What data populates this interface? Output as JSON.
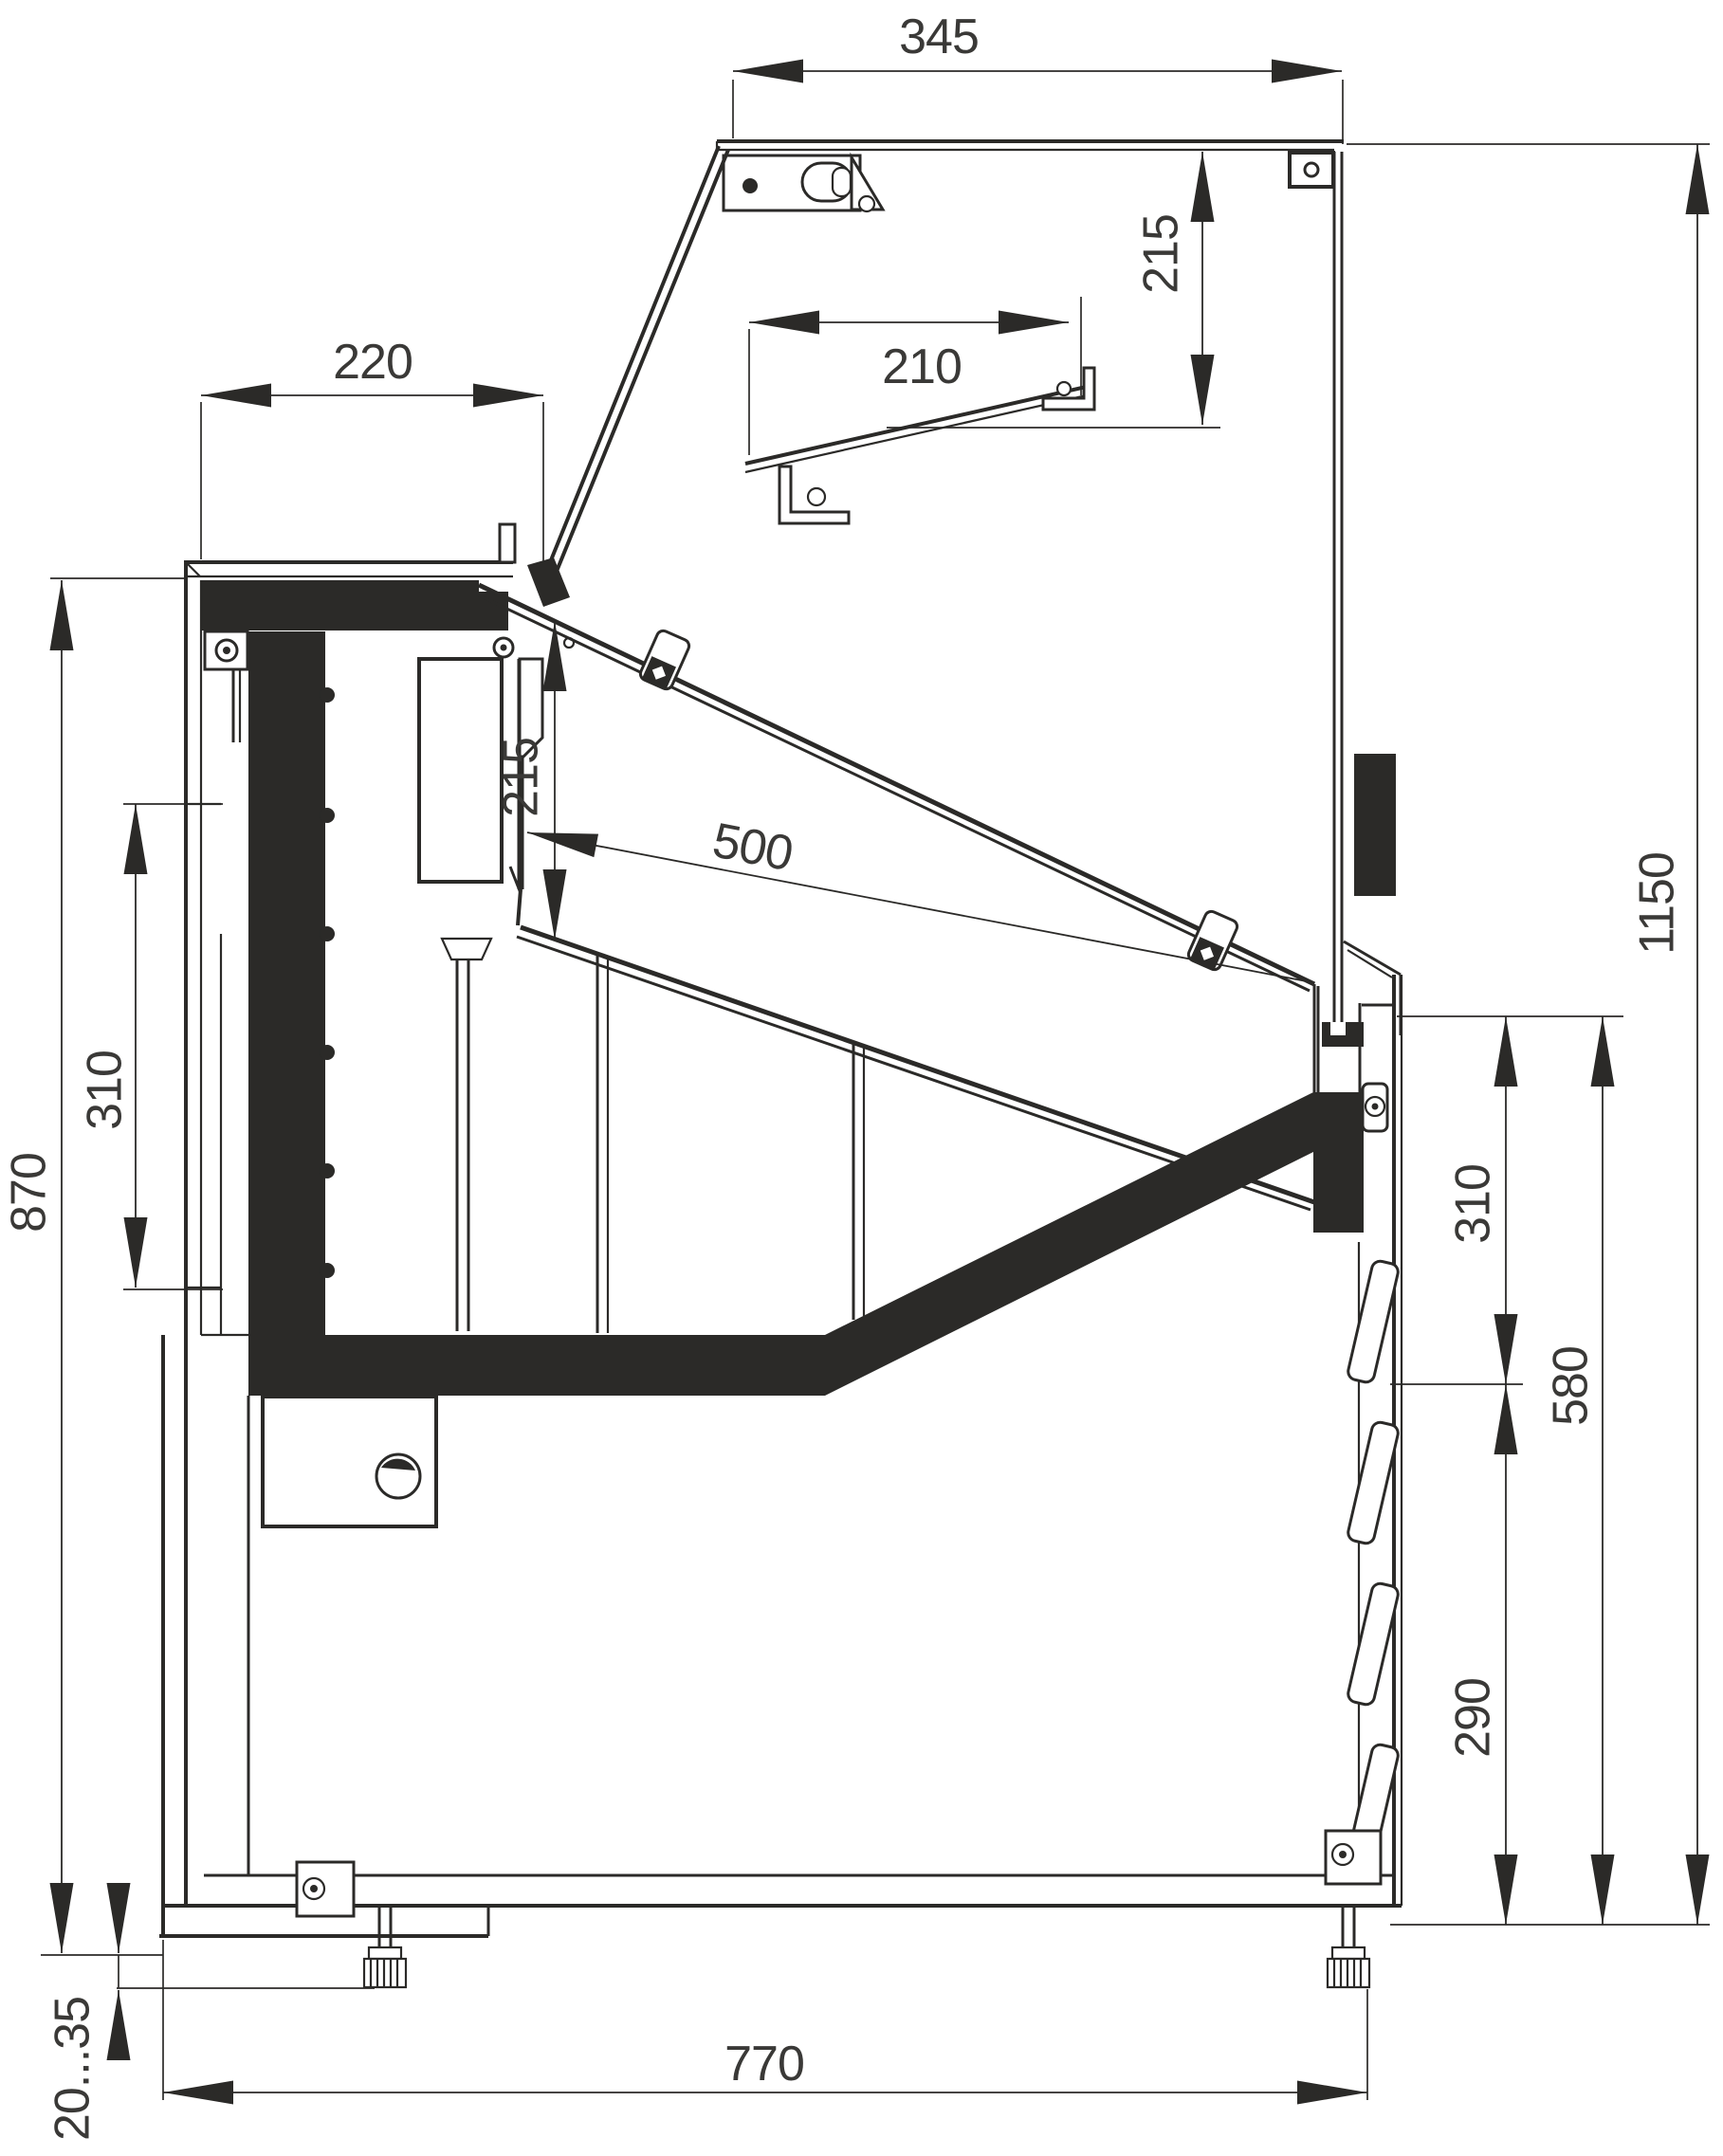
{
  "drawing": {
    "kind": "technical-section",
    "subject": "refrigerated serve-over display counter, side cross-section",
    "units": "mm",
    "dimensions": {
      "canopy_depth": "345",
      "canopy_opening_height": "215",
      "countertop_depth": "220",
      "shelf_width": "210",
      "display_deck_length": "500",
      "deck_well_height": "215",
      "rear_panel_module": "310",
      "service_side_height": "870",
      "front_glass_module": "310",
      "front_grille_height": "290",
      "base_front_height": "580",
      "overall_height": "1150",
      "base_depth": "770",
      "leveling_range": "20...35"
    }
  }
}
